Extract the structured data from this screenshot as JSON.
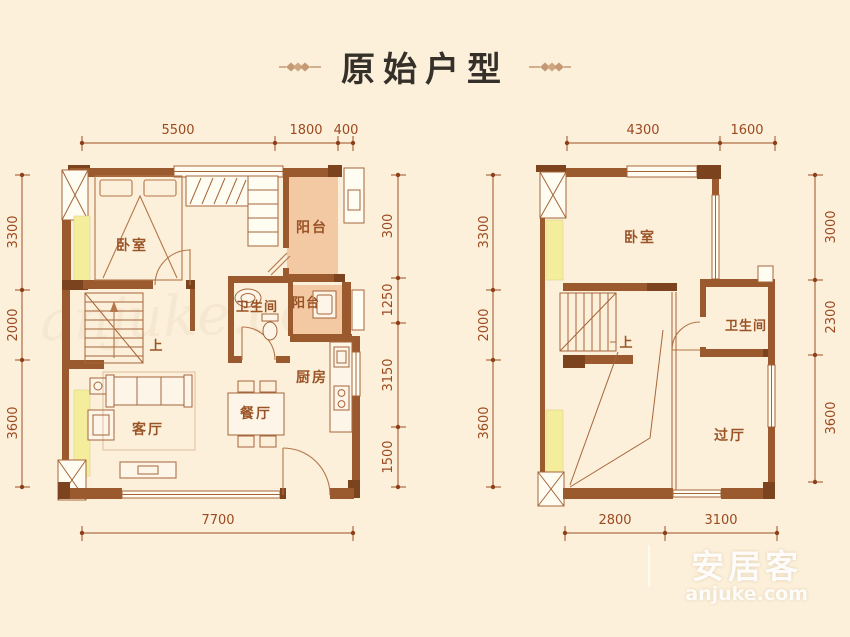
{
  "page": {
    "title_cn": "原始户型"
  },
  "brand": {
    "name": "安居客",
    "domain": "anjuke.com",
    "center_watermark": "anjuke.com"
  },
  "left_plan": {
    "dims_top": [
      "5500",
      "1800",
      "400"
    ],
    "dims_left": [
      "3300",
      "2000",
      "3600"
    ],
    "dims_right": [
      "300",
      "1250",
      "3150",
      "1500"
    ],
    "dims_bottom": [
      "7700"
    ],
    "rooms": {
      "bedroom": "卧室",
      "balcony_top": "阳台",
      "balcony_small": "阳台",
      "bathroom": "卫生间",
      "kitchen": "厨房",
      "dining": "餐厅",
      "living": "客厅",
      "stairs_up": "上"
    }
  },
  "right_plan": {
    "dims_top": [
      "4300",
      "1600"
    ],
    "dims_left": [
      "3300",
      "2000",
      "3600"
    ],
    "dims_right": [
      "3000",
      "2300",
      "3600"
    ],
    "dims_bottom": [
      "2800",
      "3100"
    ],
    "rooms": {
      "bedroom": "卧室",
      "bathroom": "卫生间",
      "hall": "过厅",
      "stairs_up": "上"
    }
  },
  "colors": {
    "background": "#fcf0da",
    "wall": "#9a5a2d",
    "wall_dark": "#7c441e",
    "dimension": "#9c4f24",
    "balcony_fill": "#f2c9a2",
    "highlight_yellow": "#f4ee9c",
    "title_text": "#35302a",
    "ornament": "#c49a75"
  }
}
